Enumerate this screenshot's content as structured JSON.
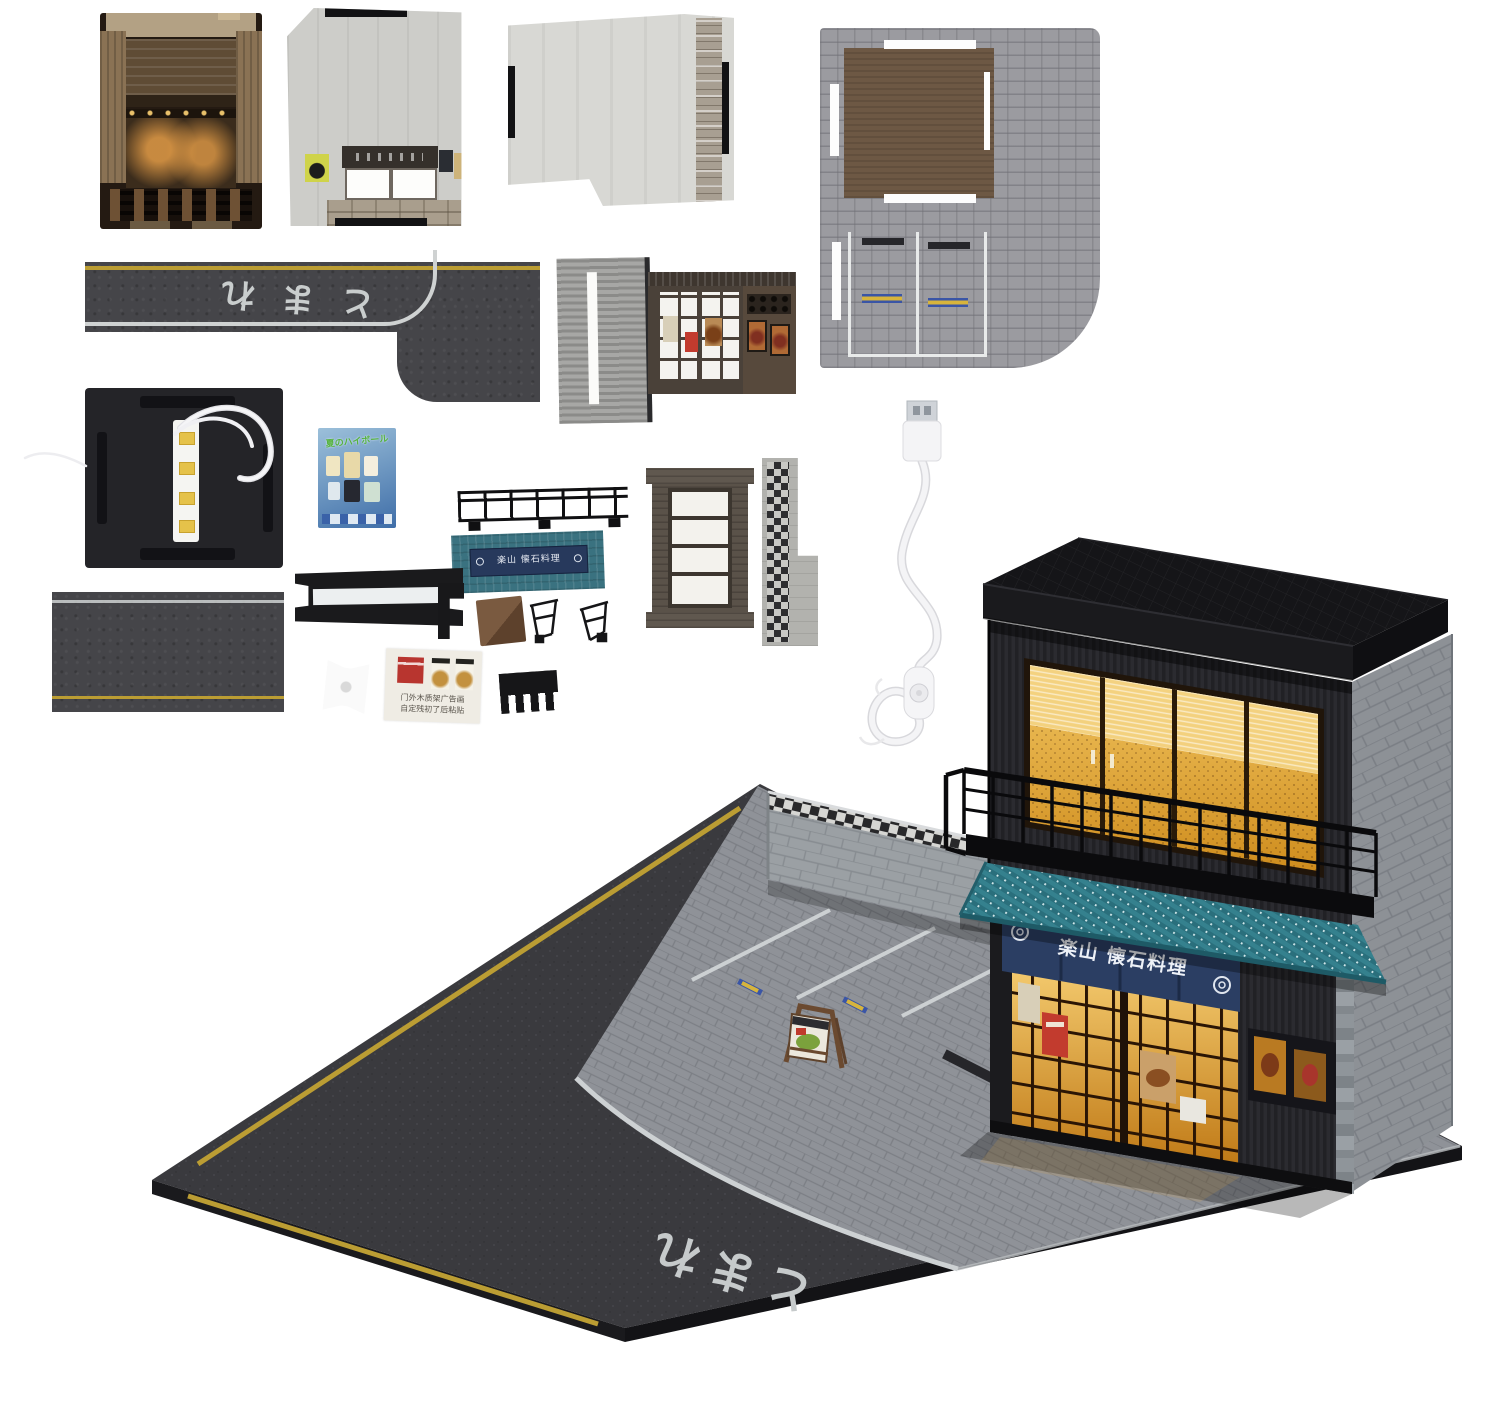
{
  "texts": {
    "road_marking": "とまれ",
    "noren_sign": "楽山 懐石料理",
    "awning_sign": "楽山 懐石料理",
    "poster_sheet_title": "夏のハイボール",
    "sticker_card_line1": "门外木质架广告画",
    "sticker_card_line2": "自定残初了后粘贴"
  },
  "colors": {
    "awning_teal": "#2e7a86",
    "noren_navy": "#2b3e63",
    "window_glow": "#e8a93c",
    "asphalt": "#3c3c3e",
    "cobblestone": "#8f9296",
    "road_yellow": "#bb9d33",
    "road_white": "#cfd2d2"
  }
}
